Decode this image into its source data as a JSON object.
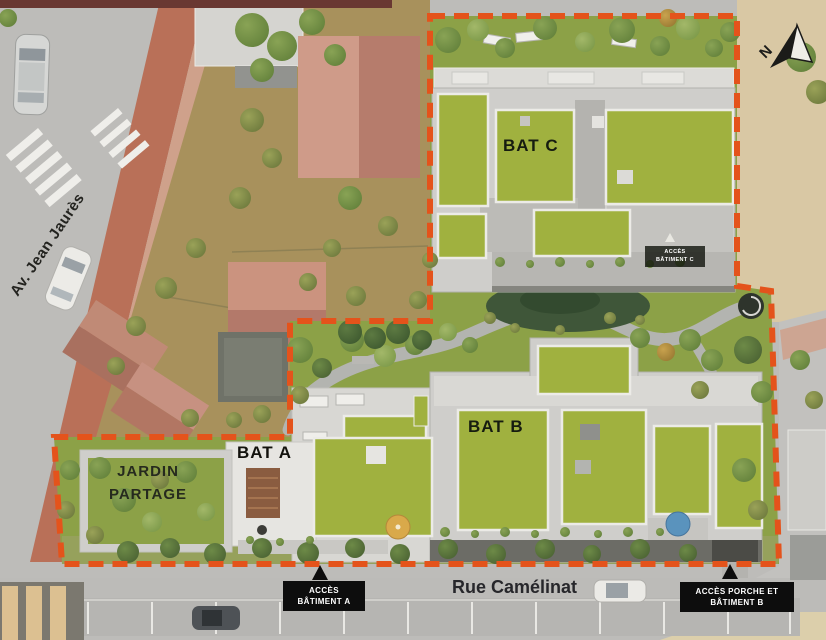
{
  "site_plan": {
    "streets": {
      "left_avenue": "Av. Jean Jaurès",
      "bottom_street": "Rue Camélinat"
    },
    "buildings": {
      "a": "BAT A",
      "b": "BAT B",
      "c": "BAT C"
    },
    "shared_garden": {
      "line1": "JARDIN",
      "line2": "PARTAGE"
    },
    "access_labels": {
      "a": {
        "line1": "ACCÈS",
        "line2": "BÂTIMENT A"
      },
      "b": {
        "line1": "ACCÈS PORCHE ET",
        "line2": "BÂTIMENT B"
      },
      "c": {
        "line1": "ACCÈS",
        "line2": "BÂTIMENT C"
      }
    },
    "compass": {
      "north": "N"
    },
    "colors": {
      "boundary_dash": "#e4531b",
      "site_grass": "#8ca147",
      "green_roof": "#a0b13f",
      "concrete_roof": "#cfcecb",
      "neighbor_dirt": "#a8915c",
      "brick_sidewalk": "#b97058",
      "street_gray": "#bdbcb9",
      "beige_lot": "#d9c8a4",
      "label_box_bg": "#0d0d0d",
      "label_box_text": "#ffffff"
    }
  }
}
